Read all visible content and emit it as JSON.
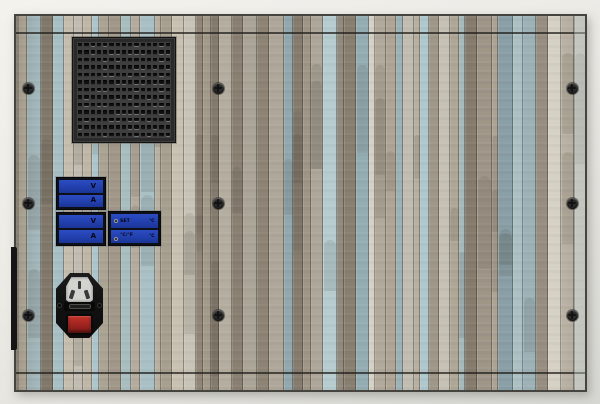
{
  "meters": {
    "top": {
      "rows": [
        {
          "label": "V"
        },
        {
          "label": "A"
        }
      ]
    },
    "bottom": {
      "rows": [
        {
          "label": "V"
        },
        {
          "label": "A"
        }
      ]
    }
  },
  "temp_controller": {
    "set_label": "SET",
    "set_unit": "°C",
    "mode_label": "°C/°F",
    "mode_unit": "°C"
  },
  "colors": {
    "meter_blue": "#2240ae",
    "module_frame": "#0e1018",
    "switch_red": "#a42521",
    "grille_body": "#3e3e3e",
    "grille_hole": "#111111",
    "panel_outline": "#45443f",
    "screw_dark": "#2c2c2c",
    "background_top": "#f4f2ed",
    "background_bottom": "#d7d8d3",
    "wood_palette": [
      "#b6afa1",
      "#a6bdc2",
      "#c6c1b5",
      "#9b9284",
      "#8fa7ad",
      "#b1a998",
      "#c9c4b8",
      "#877e70",
      "#aec3c6",
      "#bdb5a6",
      "#a39a8b"
    ]
  }
}
